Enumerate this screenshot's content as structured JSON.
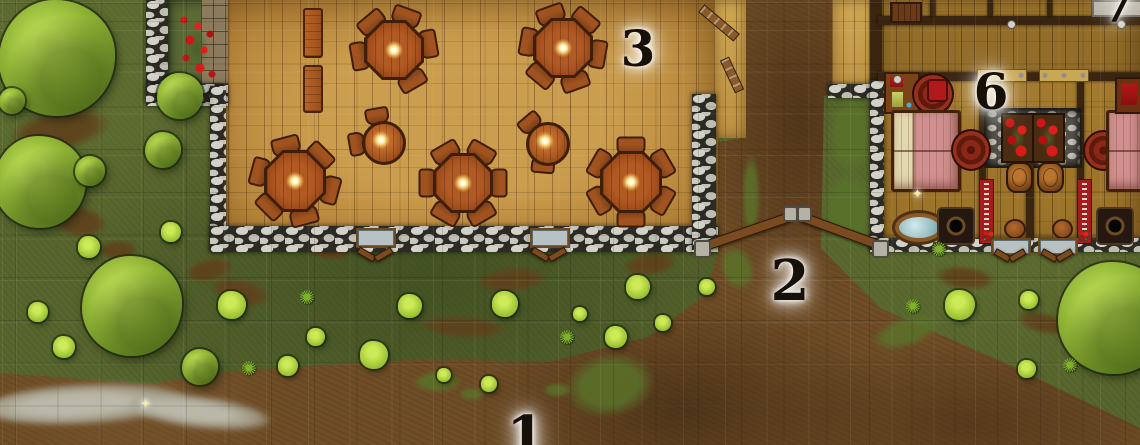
{
  "map": {
    "type": "tavern-village-battle-map",
    "grid_size_px": 42.7,
    "palette": {
      "grass": "#57662e",
      "dirt": "#6f4d26",
      "tavern_floor": "#c29246",
      "inn_floor": "#a17a2f",
      "stone_wall": "#c4c4ba",
      "table_wood": "#a2501d",
      "bed_blanket": "#d09090",
      "bed_pillow": "#e2d8b0",
      "flower_red": "#cc1616",
      "tree_green": "#8fb235",
      "label_ink": "#171008",
      "label_glow": "#ffffff"
    },
    "location_labels": [
      {
        "id": "1",
        "x": 526,
        "y": 437,
        "size": 56
      },
      {
        "id": "2",
        "x": 790,
        "y": 281,
        "size": 56
      },
      {
        "id": "3",
        "x": 638,
        "y": 49,
        "size": 50
      },
      {
        "id": "6",
        "x": 991,
        "y": 92,
        "size": 50
      },
      {
        "id": "7",
        "x": 1118,
        "y": 5,
        "size": 50
      }
    ],
    "tables_large": [
      {
        "x": 394,
        "y": 50,
        "r": 30,
        "chairs": [
          170,
          230,
          290,
          350,
          60
        ]
      },
      {
        "x": 563,
        "y": 48,
        "r": 30,
        "chairs": [
          10,
          70,
          130,
          190,
          250,
          310
        ]
      },
      {
        "x": 295,
        "y": 181,
        "r": 31,
        "chairs": [
          15,
          75,
          135,
          195,
          255,
          315
        ]
      },
      {
        "x": 463,
        "y": 183,
        "r": 30,
        "chairs": [
          0,
          60,
          120,
          180,
          240,
          300
        ]
      },
      {
        "x": 631,
        "y": 182,
        "r": 31,
        "chairs": [
          30,
          90,
          150,
          210,
          270,
          330
        ]
      }
    ],
    "tables_small": [
      {
        "x": 381,
        "y": 140,
        "r": 19,
        "chairs": [
          170,
          260
        ]
      },
      {
        "x": 545,
        "y": 141,
        "r": 19,
        "chairs": [
          95,
          230
        ]
      }
    ],
    "benches": [
      {
        "x": 303,
        "y": 8,
        "w": 16,
        "h": 46
      },
      {
        "x": 303,
        "y": 65,
        "w": 16,
        "h": 44
      }
    ],
    "trees": [
      {
        "x": 57,
        "y": 58,
        "r": 58
      },
      {
        "x": 180,
        "y": 96,
        "r": 23
      },
      {
        "x": 12,
        "y": 101,
        "r": 13
      },
      {
        "x": 40,
        "y": 182,
        "r": 46
      },
      {
        "x": 90,
        "y": 171,
        "r": 15
      },
      {
        "x": 163,
        "y": 150,
        "r": 18
      },
      {
        "x": 132,
        "y": 306,
        "r": 50
      },
      {
        "x": 200,
        "y": 367,
        "r": 18
      },
      {
        "x": 1114,
        "y": 318,
        "r": 56
      }
    ],
    "bushes": [
      {
        "x": 89,
        "y": 247,
        "r": 11
      },
      {
        "x": 171,
        "y": 232,
        "r": 10
      },
      {
        "x": 38,
        "y": 312,
        "r": 10
      },
      {
        "x": 64,
        "y": 347,
        "r": 11
      },
      {
        "x": 232,
        "y": 305,
        "r": 14
      },
      {
        "x": 288,
        "y": 366,
        "r": 10
      },
      {
        "x": 316,
        "y": 337,
        "r": 9
      },
      {
        "x": 374,
        "y": 355,
        "r": 14
      },
      {
        "x": 410,
        "y": 306,
        "r": 12
      },
      {
        "x": 505,
        "y": 304,
        "r": 13
      },
      {
        "x": 580,
        "y": 314,
        "r": 7
      },
      {
        "x": 638,
        "y": 287,
        "r": 12
      },
      {
        "x": 616,
        "y": 337,
        "r": 11
      },
      {
        "x": 663,
        "y": 323,
        "r": 8
      },
      {
        "x": 707,
        "y": 287,
        "r": 8
      },
      {
        "x": 960,
        "y": 305,
        "r": 15
      },
      {
        "x": 1029,
        "y": 300,
        "r": 9
      },
      {
        "x": 1027,
        "y": 369,
        "r": 9
      },
      {
        "x": 489,
        "y": 384,
        "r": 8
      },
      {
        "x": 444,
        "y": 375,
        "r": 7
      }
    ],
    "plants": [
      {
        "x": 250,
        "y": 369
      },
      {
        "x": 914,
        "y": 307
      },
      {
        "x": 1071,
        "y": 366
      },
      {
        "x": 940,
        "y": 250
      },
      {
        "x": 308,
        "y": 298
      },
      {
        "x": 568,
        "y": 338
      }
    ],
    "dirt_patches": [
      {
        "x": 60,
        "y": 130,
        "w": 104,
        "h": 42,
        "rot": -10
      },
      {
        "x": 80,
        "y": 222,
        "w": 56,
        "h": 32,
        "rot": 8
      },
      {
        "x": 240,
        "y": 292,
        "w": 62,
        "h": 28,
        "rot": 12
      },
      {
        "x": 512,
        "y": 280,
        "w": 72,
        "h": 26,
        "rot": -5
      },
      {
        "x": 650,
        "y": 264,
        "w": 56,
        "h": 24,
        "rot": -8
      },
      {
        "x": 209,
        "y": 270,
        "w": 50,
        "h": 24,
        "rot": -14
      },
      {
        "x": 965,
        "y": 278,
        "w": 62,
        "h": 24,
        "rot": 6
      },
      {
        "x": 118,
        "y": 250,
        "w": 40,
        "h": 20,
        "rot": 0
      },
      {
        "x": 330,
        "y": 252,
        "w": 44,
        "h": 16,
        "rot": 4
      },
      {
        "x": 463,
        "y": 327,
        "w": 90,
        "h": 22,
        "rot": 3
      },
      {
        "x": 1043,
        "y": 323,
        "w": 56,
        "h": 22,
        "rot": 14
      }
    ],
    "grass_tufts": [
      {
        "x": 851,
        "y": 135,
        "w": 44,
        "h": 84,
        "rot": 0
      },
      {
        "x": 849,
        "y": 210,
        "w": 52,
        "h": 80,
        "rot": 0
      },
      {
        "x": 751,
        "y": 195,
        "w": 18,
        "h": 85,
        "rot": 0
      },
      {
        "x": 737,
        "y": 268,
        "w": 34,
        "h": 46,
        "rot": -20
      },
      {
        "x": 610,
        "y": 385,
        "w": 90,
        "h": 64,
        "rot": -10
      },
      {
        "x": 437,
        "y": 382,
        "w": 50,
        "h": 22,
        "rot": 0
      },
      {
        "x": 557,
        "y": 390,
        "w": 28,
        "h": 14,
        "rot": 0
      },
      {
        "x": 906,
        "y": 332,
        "w": 70,
        "h": 30,
        "rot": -18
      },
      {
        "x": 472,
        "y": 394,
        "w": 26,
        "h": 12,
        "rot": 0
      }
    ],
    "furniture": [
      {
        "name": "writing-desk",
        "cls": "desk",
        "x": 884,
        "y": 72,
        "w": 32,
        "h": 38
      },
      {
        "name": "round-rug",
        "cls": "rug",
        "x": 912,
        "y": 73,
        "w": 38,
        "h": 38
      },
      {
        "name": "chair-cushion",
        "cls": "cushion",
        "x": 927,
        "y": 79,
        "w": 17,
        "h": 19
      },
      {
        "name": "double-bed",
        "cls": "bed",
        "x": 891,
        "y": 110,
        "w": 64,
        "h": 76
      },
      {
        "name": "round-rug",
        "cls": "rug",
        "x": 951,
        "y": 129,
        "w": 36,
        "h": 38
      },
      {
        "name": "bathtub",
        "cls": "tub",
        "x": 892,
        "y": 210,
        "w": 48,
        "h": 29
      },
      {
        "name": "privy-mat",
        "cls": "privy",
        "x": 937,
        "y": 207,
        "w": 34,
        "h": 34
      },
      {
        "name": "wall-banner",
        "cls": "banner",
        "x": 979,
        "y": 179,
        "w": 13,
        "h": 63
      },
      {
        "name": "keg",
        "cls": "barrel",
        "x": 1006,
        "y": 162,
        "w": 23,
        "h": 27
      },
      {
        "name": "keg",
        "cls": "barrel",
        "x": 1037,
        "y": 162,
        "w": 23,
        "h": 27
      },
      {
        "name": "stool",
        "cls": "stool",
        "x": 1004,
        "y": 219,
        "w": 18,
        "h": 16
      },
      {
        "name": "stool",
        "cls": "stool",
        "x": 1052,
        "y": 219,
        "w": 17,
        "h": 16
      },
      {
        "name": "flower-planter",
        "cls": "planter",
        "x": 1001,
        "y": 113,
        "w": 29,
        "h": 46
      },
      {
        "name": "flower-planter",
        "cls": "planter",
        "x": 1032,
        "y": 113,
        "w": 29,
        "h": 46
      },
      {
        "name": "wall-banner",
        "cls": "banner",
        "x": 1077,
        "y": 179,
        "w": 13,
        "h": 63
      },
      {
        "name": "privy-mat",
        "cls": "privy",
        "x": 1096,
        "y": 207,
        "w": 34,
        "h": 34
      },
      {
        "name": "round-rug",
        "cls": "rug",
        "x": 1083,
        "y": 130,
        "w": 37,
        "h": 37
      },
      {
        "name": "double-bed",
        "cls": "bed-b",
        "x": 1106,
        "y": 110,
        "w": 34,
        "h": 76
      },
      {
        "name": "side-desk",
        "cls": "desk-b",
        "x": 1115,
        "y": 77,
        "w": 25,
        "h": 33
      },
      {
        "name": "door",
        "cls": "door",
        "x": 890,
        "y": 2,
        "w": 28,
        "h": 17
      },
      {
        "name": "bed-head",
        "cls": "pale-block",
        "x": 1092,
        "y": 0,
        "w": 48,
        "h": 13
      },
      {
        "name": "open-door-panel",
        "cls": "hatch",
        "x": 977,
        "y": 69,
        "w": 48,
        "h": 11
      },
      {
        "name": "open-door-panel",
        "cls": "hatch",
        "x": 1039,
        "y": 69,
        "w": 48,
        "h": 11
      },
      {
        "name": "window",
        "cls": "window",
        "x": 993,
        "y": 240,
        "w": 34,
        "h": 12
      },
      {
        "name": "window",
        "cls": "window",
        "x": 1040,
        "y": 240,
        "w": 34,
        "h": 12
      },
      {
        "name": "flower-box",
        "cls": "flowerbox",
        "x": 983,
        "y": 230,
        "w": 11,
        "h": 11
      },
      {
        "name": "flower-box",
        "cls": "flowerbox",
        "x": 1078,
        "y": 230,
        "w": 11,
        "h": 11
      },
      {
        "name": "wall-sconce",
        "cls": "sconce",
        "x": 1007,
        "y": 20,
        "w": 7,
        "h": 7
      },
      {
        "name": "wall-sconce",
        "cls": "sconce",
        "x": 1117,
        "y": 20,
        "w": 7,
        "h": 7
      },
      {
        "name": "wall-sconce",
        "cls": "sconce",
        "x": 893,
        "y": 75,
        "w": 7,
        "h": 7
      },
      {
        "name": "window",
        "cls": "window",
        "x": 358,
        "y": 230,
        "w": 34,
        "h": 14
      },
      {
        "name": "window",
        "cls": "window",
        "x": 532,
        "y": 230,
        "w": 34,
        "h": 14
      },
      {
        "name": "shutter",
        "cls": "rail",
        "x": 357,
        "y": 251,
        "w": 17,
        "h": 5,
        "rot": 30
      },
      {
        "name": "shutter",
        "cls": "rail",
        "x": 374,
        "y": 251,
        "w": 17,
        "h": 5,
        "rot": -30
      },
      {
        "name": "shutter",
        "cls": "rail",
        "x": 531,
        "y": 251,
        "w": 17,
        "h": 5,
        "rot": 30
      },
      {
        "name": "shutter",
        "cls": "rail",
        "x": 548,
        "y": 251,
        "w": 17,
        "h": 5,
        "rot": -30
      },
      {
        "name": "shutter",
        "cls": "rail",
        "x": 994,
        "y": 252,
        "w": 15,
        "h": 5,
        "rot": 30
      },
      {
        "name": "shutter",
        "cls": "rail",
        "x": 1009,
        "y": 252,
        "w": 15,
        "h": 5,
        "rot": -30
      },
      {
        "name": "shutter",
        "cls": "rail",
        "x": 1041,
        "y": 252,
        "w": 15,
        "h": 5,
        "rot": 30
      },
      {
        "name": "shutter",
        "cls": "rail",
        "x": 1056,
        "y": 252,
        "w": 15,
        "h": 5,
        "rot": -30
      },
      {
        "name": "open-door-leaf",
        "cls": "leaf",
        "x": 696,
        "y": 18,
        "w": 44,
        "h": 8,
        "rot": 40
      },
      {
        "name": "open-door-leaf",
        "cls": "leaf",
        "x": 714,
        "y": 70,
        "w": 34,
        "h": 8,
        "rot": 65
      },
      {
        "name": "gate-rail",
        "cls": "rail",
        "x": 698,
        "y": 227,
        "w": 94,
        "h": 8,
        "rot": -19
      },
      {
        "name": "gate-rail",
        "cls": "rail",
        "x": 797,
        "y": 227,
        "w": 90,
        "h": 8,
        "rot": 20
      },
      {
        "name": "gate-post",
        "cls": "post",
        "x": 694,
        "y": 240,
        "w": 13,
        "h": 14
      },
      {
        "name": "gate-post",
        "cls": "post",
        "x": 783,
        "y": 206,
        "w": 11,
        "h": 12
      },
      {
        "name": "gate-post",
        "cls": "post",
        "x": 797,
        "y": 206,
        "w": 11,
        "h": 12
      },
      {
        "name": "gate-post",
        "cls": "post",
        "x": 872,
        "y": 240,
        "w": 13,
        "h": 14
      }
    ],
    "sparkles": [
      {
        "x": 912,
        "y": 188
      },
      {
        "x": 140,
        "y": 398
      }
    ],
    "icon_glyphs": {
      "plant-icon": "✺",
      "sparkle-icon": "✦"
    }
  }
}
